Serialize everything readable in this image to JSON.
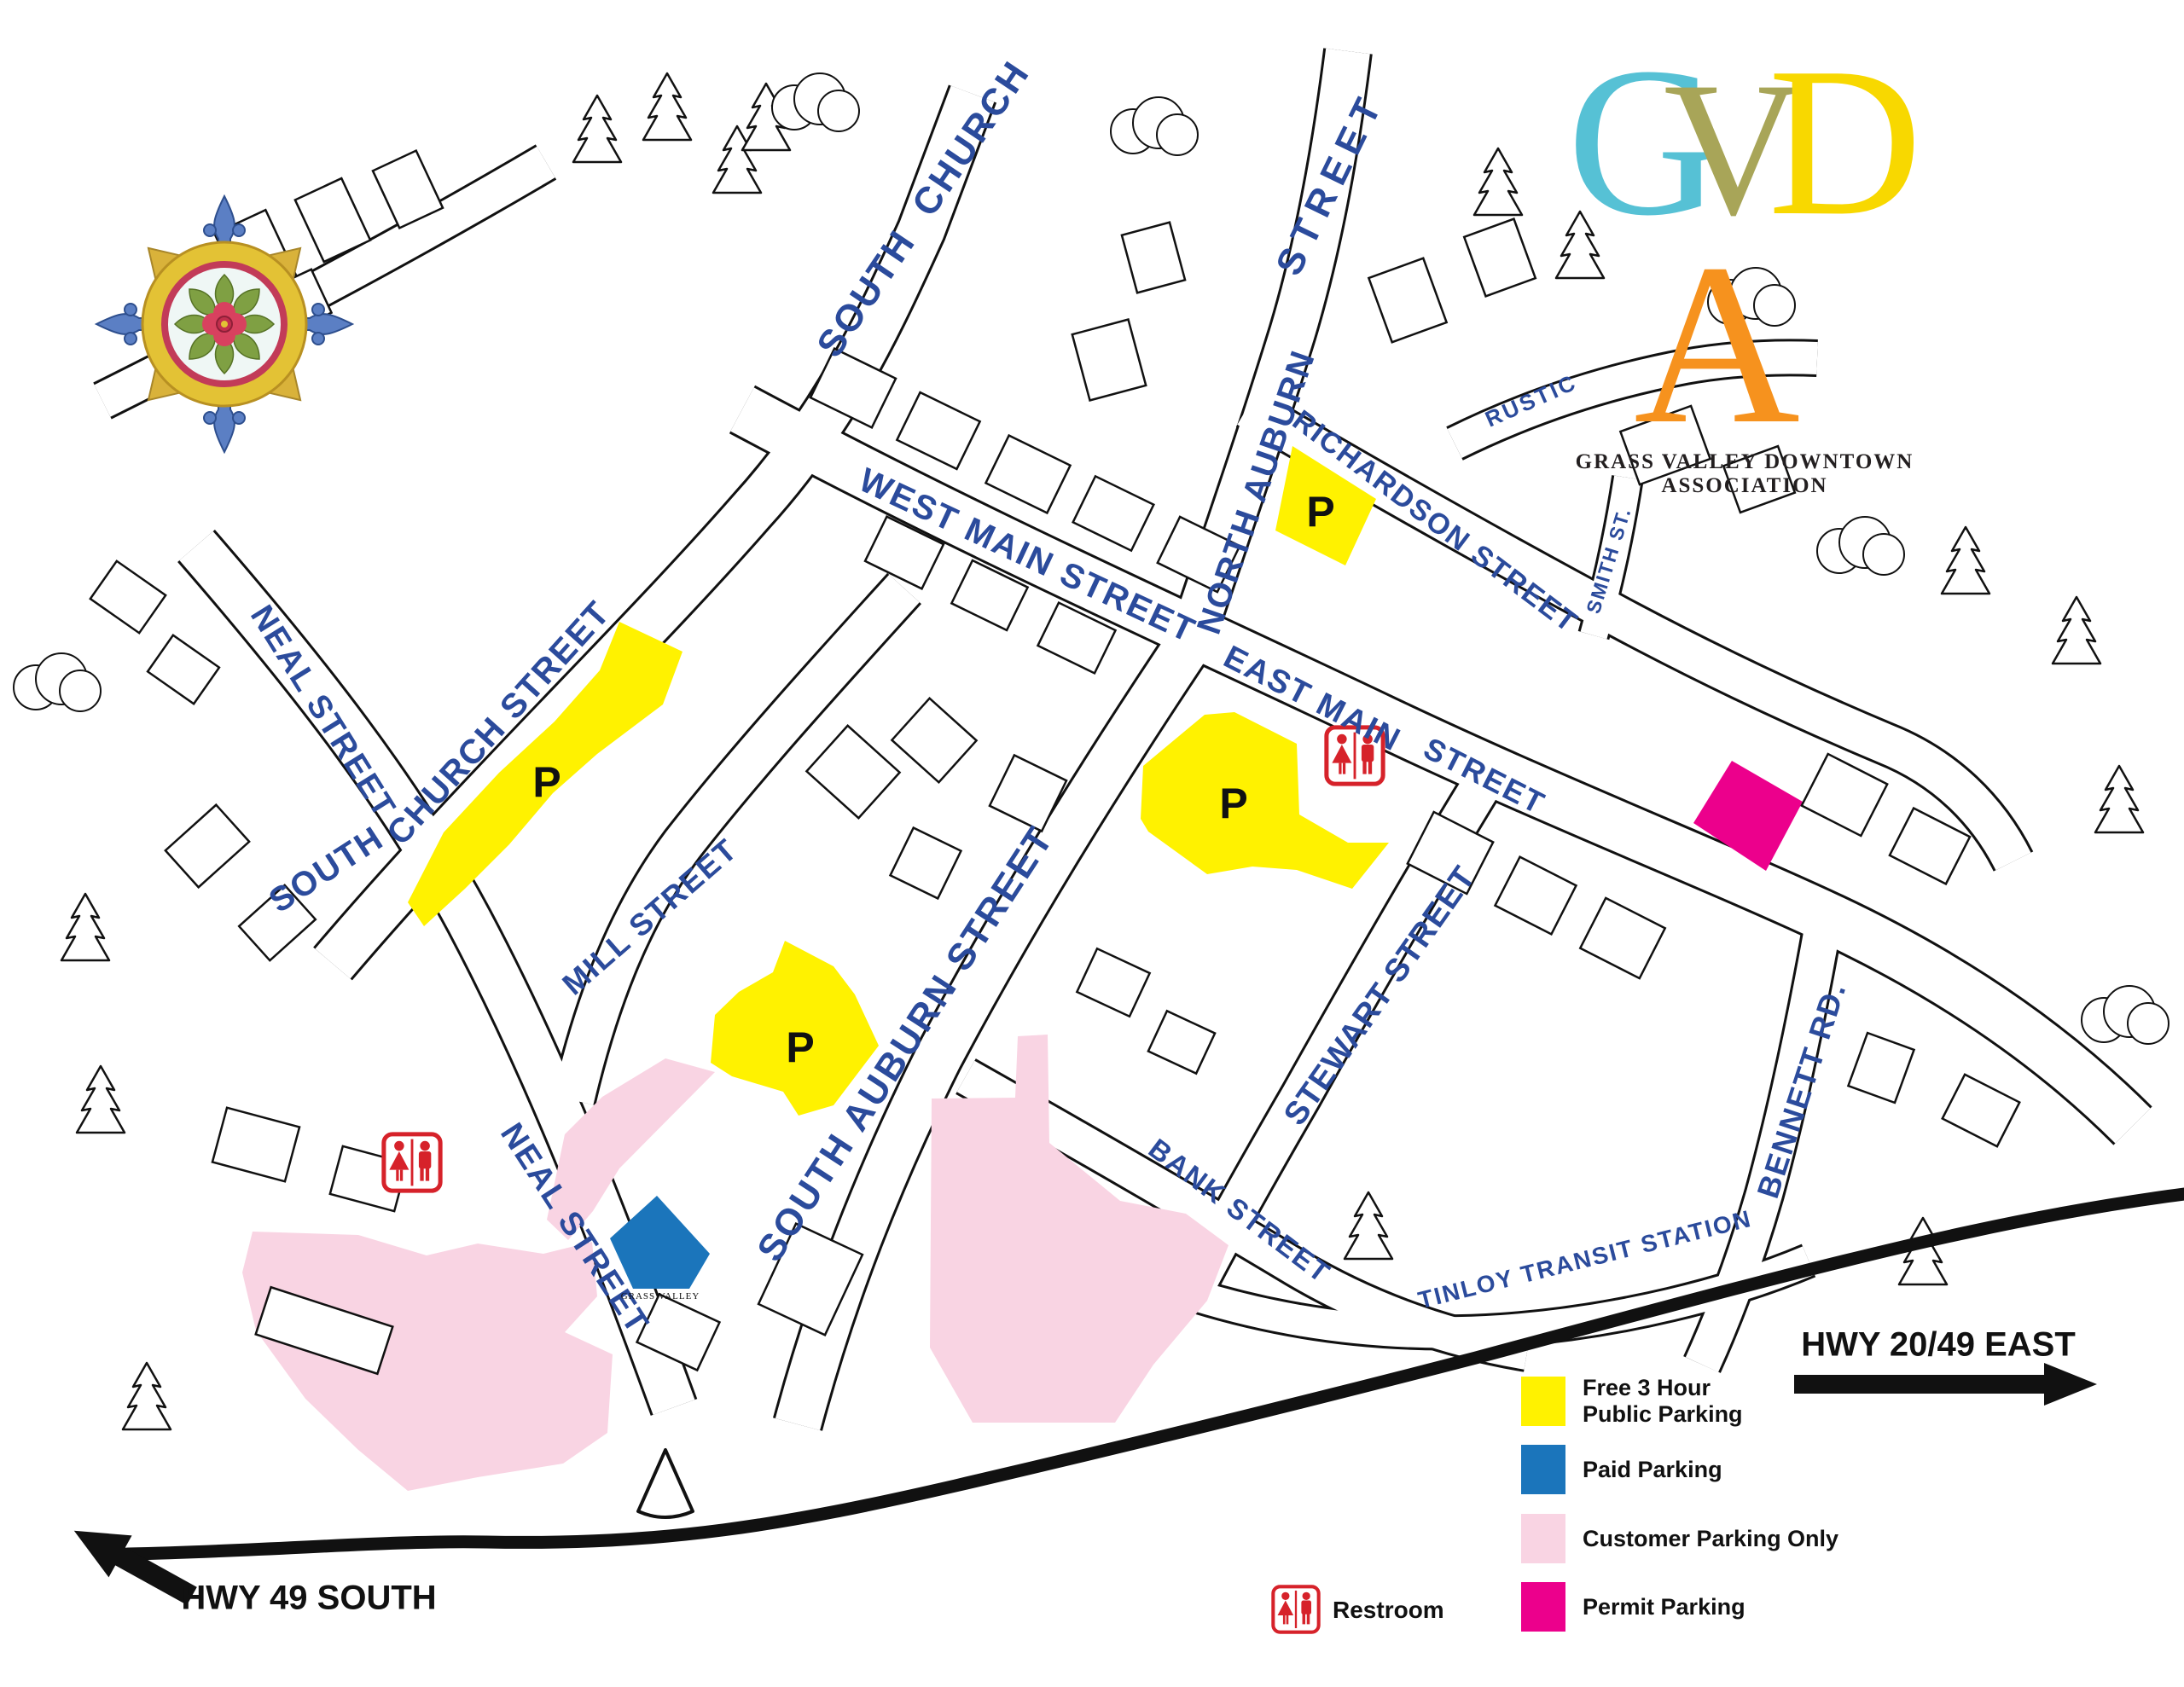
{
  "logo": {
    "letters": [
      {
        "char": "G",
        "color": "#56c1d5"
      },
      {
        "char": "V",
        "color": "#a8a558"
      },
      {
        "char": "D",
        "color": "#f8d800"
      },
      {
        "char": "A",
        "color": "#f6921e"
      }
    ],
    "tagline": "GRASS VALLEY DOWNTOWN ASSOCIATION"
  },
  "streets": [
    {
      "id": "south-church-north",
      "label": "SOUTH  CHURCH"
    },
    {
      "id": "west-main-street",
      "label": "WEST MAIN STREET"
    },
    {
      "id": "north-auburn",
      "label": "NORTH AUBURN"
    },
    {
      "id": "north-auburn-street-word",
      "label": "STREET"
    },
    {
      "id": "richardson-street",
      "label": "RICHARDSON STREET"
    },
    {
      "id": "rustic",
      "label": "RUSTIC"
    },
    {
      "id": "smith-st",
      "label": "SMITH ST."
    },
    {
      "id": "east-main",
      "label": "EAST MAIN"
    },
    {
      "id": "east-main-street-word",
      "label": "STREET"
    },
    {
      "id": "neal-street-upper",
      "label": "NEAL STREET"
    },
    {
      "id": "south-church-south-word",
      "label": "SOUTH"
    },
    {
      "id": "church-street",
      "label": "CHURCH STREET"
    },
    {
      "id": "mill-street",
      "label": "MILL STREET"
    },
    {
      "id": "south-auburn-street",
      "label": "SOUTH AUBURN STREET"
    },
    {
      "id": "neal-street-lower",
      "label": "NEAL STREET"
    },
    {
      "id": "stewart-street",
      "label": "STEWART STREET"
    },
    {
      "id": "bank-street",
      "label": "BANK STREET"
    },
    {
      "id": "bennett-rd",
      "label": "BENNETT RD."
    },
    {
      "id": "tinloy-transit-station",
      "label": "TINLOY TRANSIT STATION"
    }
  ],
  "parking_marks": [
    "P",
    "P",
    "P",
    "P"
  ],
  "signs": {
    "grass_valley_sign": "GRASS VALLEY"
  },
  "highways": {
    "east": "HWY 20/49 EAST",
    "south": "HWY 49 SOUTH"
  },
  "legend": {
    "items": [
      {
        "line1": "Free 3 Hour",
        "line2": "Public Parking",
        "color": "#fff200"
      },
      {
        "line1": "Paid Parking",
        "line2": "",
        "color": "#1b75bb"
      },
      {
        "line1": "Customer Parking Only",
        "line2": "",
        "color": "#f9d4e3"
      },
      {
        "line1": "Permit Parking",
        "line2": "",
        "color": "#ec008c"
      }
    ],
    "restroom": "Restroom"
  },
  "map_colors": {
    "street_label": "#2b4b9c",
    "free_parking": "#fff200",
    "paid_parking": "#1b75bb",
    "customer_parking": "#f9d4e3",
    "permit_parking": "#ec008c",
    "restroom_red": "#d6222a",
    "line_art": "#111111"
  }
}
